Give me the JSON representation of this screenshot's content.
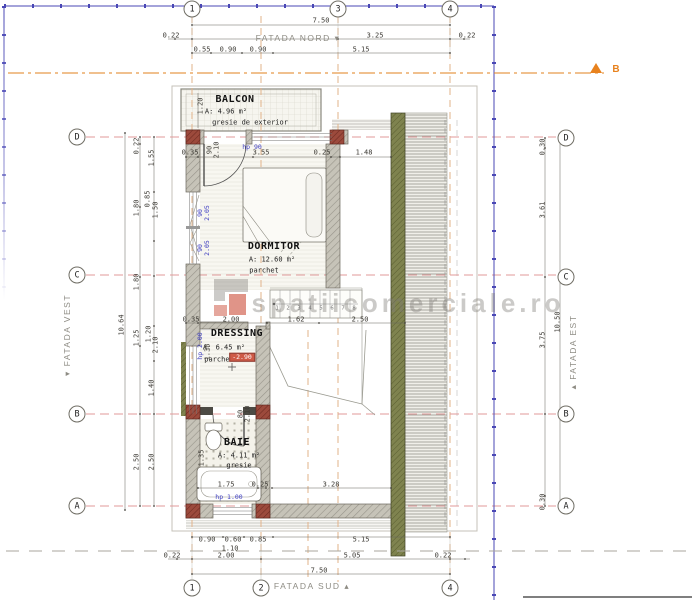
{
  "drawing": {
    "type": "basement floor plan",
    "watermark": "spatiicomerciale.ro",
    "section_marker": "B"
  },
  "colors": {
    "boundary_blue": "#4947b5",
    "axis_red": "#e09a9a",
    "axis_orange": "#e2b38a",
    "section_orange": "#e8821e",
    "wall_gray": "#c6c3b8",
    "column_red": "#9c4a3c",
    "wood_green": "#7f834f",
    "level_marker_red": "#cf5a46",
    "blue_label": "#3e3ec2"
  },
  "grid_bubbles": [
    {
      "t": "1",
      "x": 192,
      "y": 9
    },
    {
      "t": "3",
      "x": 338,
      "y": 9
    },
    {
      "t": "4",
      "x": 450,
      "y": 9
    },
    {
      "t": "1",
      "x": 192,
      "y": 588
    },
    {
      "t": "2",
      "x": 261,
      "y": 588
    },
    {
      "t": "4",
      "x": 450,
      "y": 588
    },
    {
      "t": "D",
      "x": 77,
      "y": 137
    },
    {
      "t": "C",
      "x": 77,
      "y": 275
    },
    {
      "t": "B",
      "x": 77,
      "y": 414
    },
    {
      "t": "A",
      "x": 77,
      "y": 506
    },
    {
      "t": "D",
      "x": 566,
      "y": 138
    },
    {
      "t": "C",
      "x": 566,
      "y": 277
    },
    {
      "t": "B",
      "x": 566,
      "y": 414
    },
    {
      "t": "A",
      "x": 566,
      "y": 506
    }
  ],
  "labels": [
    {
      "c": "dim",
      "t": "7.50",
      "x": 321,
      "y": 21
    },
    {
      "c": "dim",
      "t": "0.22",
      "x": 171,
      "y": 36
    },
    {
      "c": "dim",
      "t": "3.25",
      "x": 375,
      "y": 36
    },
    {
      "c": "dim",
      "t": "0.22",
      "x": 467,
      "y": 36
    },
    {
      "c": "dim",
      "t": "0.55",
      "x": 202,
      "y": 50
    },
    {
      "c": "dim",
      "t": "0.90",
      "x": 228,
      "y": 50
    },
    {
      "c": "dim",
      "t": "0.90",
      "x": 258,
      "y": 50
    },
    {
      "c": "dim",
      "t": "5.15",
      "x": 361,
      "y": 50
    },
    {
      "c": "facade",
      "t": "FATADA NORD ▾",
      "x": 298,
      "y": 38,
      "n": "facade-north-label"
    },
    {
      "c": "dim",
      "t": "0.35",
      "x": 190,
      "y": 153
    },
    {
      "c": "dim",
      "t": "3.55",
      "x": 261,
      "y": 153
    },
    {
      "c": "dim",
      "t": "0.25",
      "x": 322,
      "y": 153
    },
    {
      "c": "dim",
      "t": "1.48",
      "x": 364,
      "y": 153
    },
    {
      "c": "room",
      "t": "BALCON",
      "x": 235,
      "y": 100,
      "n": "room-balcon-label"
    },
    {
      "c": "small",
      "t": "A: 4.96 m²",
      "x": 226,
      "y": 112
    },
    {
      "c": "small",
      "t": "gresie de exterior",
      "x": 250,
      "y": 123
    },
    {
      "c": "dimv",
      "t": "1.20",
      "x": 201,
      "y": 106
    },
    {
      "c": "blue",
      "t": "hp 90",
      "x": 252,
      "y": 147
    },
    {
      "c": "dimv",
      "t": "90",
      "x": 210,
      "y": 150
    },
    {
      "c": "dimv",
      "t": "2.10",
      "x": 217,
      "y": 150
    },
    {
      "c": "room",
      "t": "DORMITOR",
      "x": 274,
      "y": 247,
      "n": "room-dormitor-label"
    },
    {
      "c": "small",
      "t": "A: 12.60 m²",
      "x": 272,
      "y": 260
    },
    {
      "c": "small",
      "t": "parchet",
      "x": 264,
      "y": 271
    },
    {
      "c": "bluev",
      "t": "90",
      "x": 200,
      "y": 213
    },
    {
      "c": "bluev",
      "t": "2.05",
      "x": 207,
      "y": 213
    },
    {
      "c": "bluev",
      "t": "90",
      "x": 200,
      "y": 248
    },
    {
      "c": "bluev",
      "t": "2.05",
      "x": 207,
      "y": 248
    },
    {
      "c": "room",
      "t": "DRESSING",
      "x": 237,
      "y": 334,
      "n": "room-dressing-label"
    },
    {
      "c": "small",
      "t": "A: 6.45 m²",
      "x": 224,
      "y": 348
    },
    {
      "c": "small",
      "t": "parchet",
      "x": 219,
      "y": 360
    },
    {
      "c": "red",
      "t": "-2.90",
      "x": 242,
      "y": 357,
      "n": "level-marker"
    },
    {
      "c": "bluev",
      "t": "hp 2.00",
      "x": 200,
      "y": 346
    },
    {
      "c": "dimv",
      "t": "1.38",
      "x": 208,
      "y": 352
    },
    {
      "c": "dim",
      "t": "0.35",
      "x": 191,
      "y": 320
    },
    {
      "c": "dim",
      "t": "2.00",
      "x": 231,
      "y": 320
    },
    {
      "c": "dim",
      "t": "1.62",
      "x": 296,
      "y": 320
    },
    {
      "c": "dim",
      "t": "2.50",
      "x": 360,
      "y": 320
    },
    {
      "c": "room",
      "t": "BAIE",
      "x": 237,
      "y": 443,
      "n": "room-baie-label"
    },
    {
      "c": "small",
      "t": "A: 4.11 m²",
      "x": 239,
      "y": 456
    },
    {
      "c": "small",
      "t": "gresie",
      "x": 239,
      "y": 466
    },
    {
      "c": "dimv",
      "t": "80",
      "x": 241,
      "y": 414
    },
    {
      "c": "dimv",
      "t": "2.10",
      "x": 248,
      "y": 414
    },
    {
      "c": "dimv",
      "t": "1.35",
      "x": 202,
      "y": 458
    },
    {
      "c": "blue",
      "t": "hp 1.00",
      "x": 229,
      "y": 497
    },
    {
      "c": "dim",
      "t": "1.75",
      "x": 226,
      "y": 485
    },
    {
      "c": "dim",
      "t": "0.25",
      "x": 260,
      "y": 485
    },
    {
      "c": "dim",
      "t": "3.28",
      "x": 331,
      "y": 485
    },
    {
      "c": "dim",
      "t": "0.90",
      "x": 207,
      "y": 540
    },
    {
      "c": "dim",
      "t": "0.60",
      "x": 233,
      "y": 540
    },
    {
      "c": "dim",
      "t": "0.85",
      "x": 258,
      "y": 540
    },
    {
      "c": "dim",
      "t": "5.15",
      "x": 361,
      "y": 540
    },
    {
      "c": "dim",
      "t": "1.10",
      "x": 230,
      "y": 549
    },
    {
      "c": "dim",
      "t": "0.22",
      "x": 172,
      "y": 556
    },
    {
      "c": "dim",
      "t": "2.00",
      "x": 226,
      "y": 556
    },
    {
      "c": "dim",
      "t": "5.05",
      "x": 352,
      "y": 556
    },
    {
      "c": "dim",
      "t": "0.22",
      "x": 443,
      "y": 556
    },
    {
      "c": "dim",
      "t": "7.50",
      "x": 319,
      "y": 571
    },
    {
      "c": "facade",
      "t": "FATADA SUD ▴",
      "x": 312,
      "y": 586,
      "n": "facade-south-label"
    },
    {
      "c": "dimv",
      "t": "10.64",
      "x": 122,
      "y": 325
    },
    {
      "c": "dimv",
      "t": "0.22",
      "x": 137,
      "y": 146
    },
    {
      "c": "dimv",
      "t": "1.80",
      "x": 137,
      "y": 208
    },
    {
      "c": "dimv",
      "t": "1.80",
      "x": 137,
      "y": 282
    },
    {
      "c": "dimv",
      "t": "1.25",
      "x": 137,
      "y": 338
    },
    {
      "c": "dimv",
      "t": "2.50",
      "x": 137,
      "y": 462
    },
    {
      "c": "dimv",
      "t": "1.55",
      "x": 152,
      "y": 158
    },
    {
      "c": "dimv",
      "t": "0.85",
      "x": 148,
      "y": 199
    },
    {
      "c": "dimv",
      "t": "1.50",
      "x": 156,
      "y": 210
    },
    {
      "c": "dimv",
      "t": "1.20",
      "x": 149,
      "y": 334
    },
    {
      "c": "dimv",
      "t": "2.10",
      "x": 156,
      "y": 345
    },
    {
      "c": "dimv",
      "t": "1.40",
      "x": 152,
      "y": 388
    },
    {
      "c": "dimv",
      "t": "2.50",
      "x": 152,
      "y": 462
    },
    {
      "c": "facadev",
      "t": "▾ FATADA VEST",
      "x": 67,
      "y": 335,
      "n": "facade-west-label"
    },
    {
      "c": "dimv",
      "t": "0.30",
      "x": 543,
      "y": 147
    },
    {
      "c": "dimv",
      "t": "3.61",
      "x": 543,
      "y": 210
    },
    {
      "c": "dimv",
      "t": "3.75",
      "x": 543,
      "y": 340
    },
    {
      "c": "dimv",
      "t": "0.30",
      "x": 543,
      "y": 502
    },
    {
      "c": "dimv",
      "t": "10.50",
      "x": 558,
      "y": 322
    },
    {
      "c": "facadev",
      "t": "▴ FATADA EST",
      "x": 573,
      "y": 352,
      "n": "facade-east-label"
    },
    {
      "c": "sectionlbl",
      "t": "B",
      "x": 616,
      "y": 70,
      "n": "section-marker-label"
    },
    {
      "c": "wm",
      "t": "spatiicomerciale.ro",
      "x": 408,
      "y": 303,
      "n": "watermark-text"
    },
    {
      "c": "stairnum",
      "t": "1",
      "x": 277,
      "y": 309
    },
    {
      "c": "stairnum",
      "t": "2",
      "x": 288,
      "y": 309
    },
    {
      "c": "stairnum",
      "t": "3",
      "x": 299,
      "y": 309
    },
    {
      "c": "stairnum",
      "t": "4",
      "x": 310,
      "y": 309
    },
    {
      "c": "stairnum",
      "t": "5",
      "x": 321,
      "y": 309
    },
    {
      "c": "stairnum",
      "t": "6",
      "x": 332,
      "y": 309
    },
    {
      "c": "stairnum",
      "t": "7",
      "x": 343,
      "y": 309
    },
    {
      "c": "stairnum",
      "t": "8",
      "x": 354,
      "y": 309
    }
  ]
}
